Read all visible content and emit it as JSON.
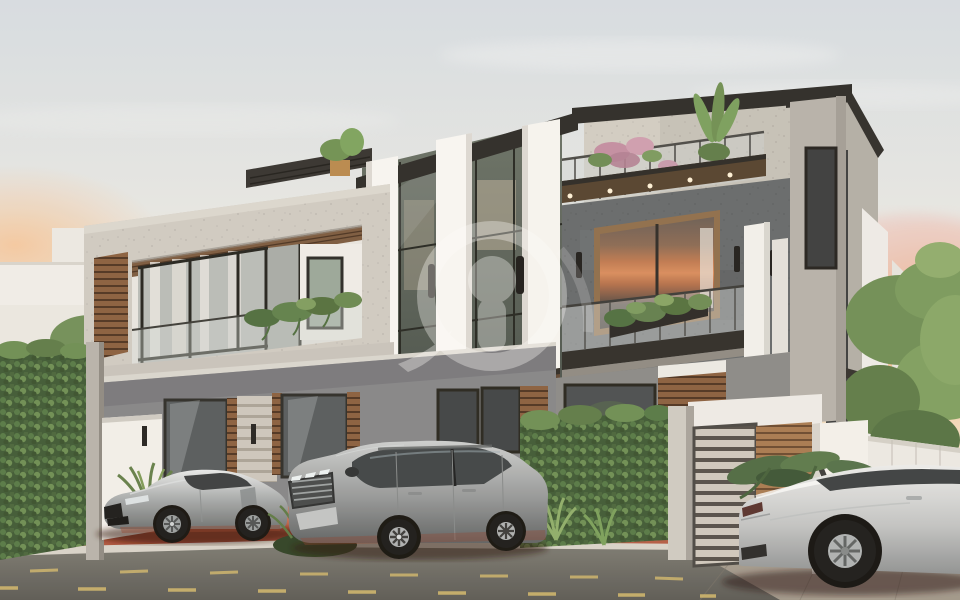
{
  "scene": {
    "type": "architectural-exterior-render",
    "description": "Modern multi-storey twin villa at sunset with textured concrete frames, white fins, glass balustrades, planted terraces, a hedge fence, gates and three parked cars on a terracotta sidewalk beside an asphalt street",
    "time_of_day": "sunset"
  },
  "sign": {
    "text": "V1"
  },
  "watermark": {
    "style": "semi-transparent white circular logo",
    "position": "center of facade"
  },
  "colors": {
    "sky_top": "#d7dee5",
    "sky_warm": "#f3ddc0",
    "sunset_glow": "#f3ae7e",
    "concrete_light": "#d0ccc5",
    "concrete_dark": "#666a6d",
    "wall_gray": "#85868a",
    "white_fin": "#f8f7f5",
    "roof_dark": "#2c2b29",
    "wood": "#8a5f40",
    "hedge_green": "#3f5a36",
    "leaf_light": "#7ba15c",
    "terracotta": "#c4684f",
    "red_glow": "#7c2514",
    "road": "#6f6e68",
    "lane_yellow": "#d4ba6e",
    "curb": "#d8d4cc",
    "car_silver": "#b9bcbe",
    "car_white": "#dfe1e1",
    "glass_dark": "#3f4447",
    "sign_text": "#3b3b3b",
    "sign_bg": "#f4f2ee",
    "watermark_color": "#ffffff"
  },
  "objects": [
    "modern-villa",
    "roof-terrace",
    "glass-balustrade",
    "balcony-planters",
    "hedge-fence",
    "garden-gate",
    "gate-pillar-sign",
    "street",
    "sidewalk",
    "sports-car-left",
    "suv-center",
    "sports-car-right",
    "tree-left",
    "trees-right",
    "watermark-logo"
  ]
}
